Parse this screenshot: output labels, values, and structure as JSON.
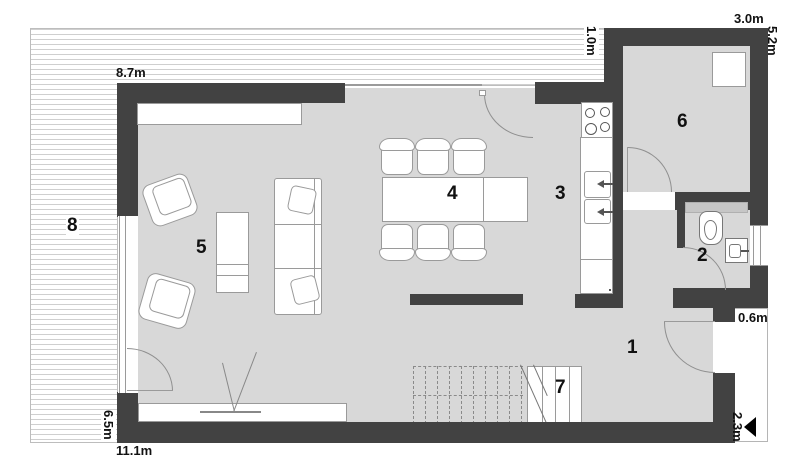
{
  "plan": {
    "rooms": [
      {
        "number": "1"
      },
      {
        "number": "2"
      },
      {
        "number": "3"
      },
      {
        "number": "4"
      },
      {
        "number": "5"
      },
      {
        "number": "6"
      },
      {
        "number": "7"
      },
      {
        "number": "8"
      }
    ],
    "dimensions": [
      {
        "text": "8.7m"
      },
      {
        "text": "1.0m"
      },
      {
        "text": "3.0m"
      },
      {
        "text": "5.2m"
      },
      {
        "text": "0.6m"
      },
      {
        "text": "2.3m"
      },
      {
        "text": "6.5m"
      },
      {
        "text": "11.1m"
      }
    ],
    "colors": {
      "wall": "#424242",
      "floor": "#d8d8d8",
      "stripe": "#cfcfcf",
      "line": "#9a9a9a",
      "text": "#111111"
    }
  }
}
